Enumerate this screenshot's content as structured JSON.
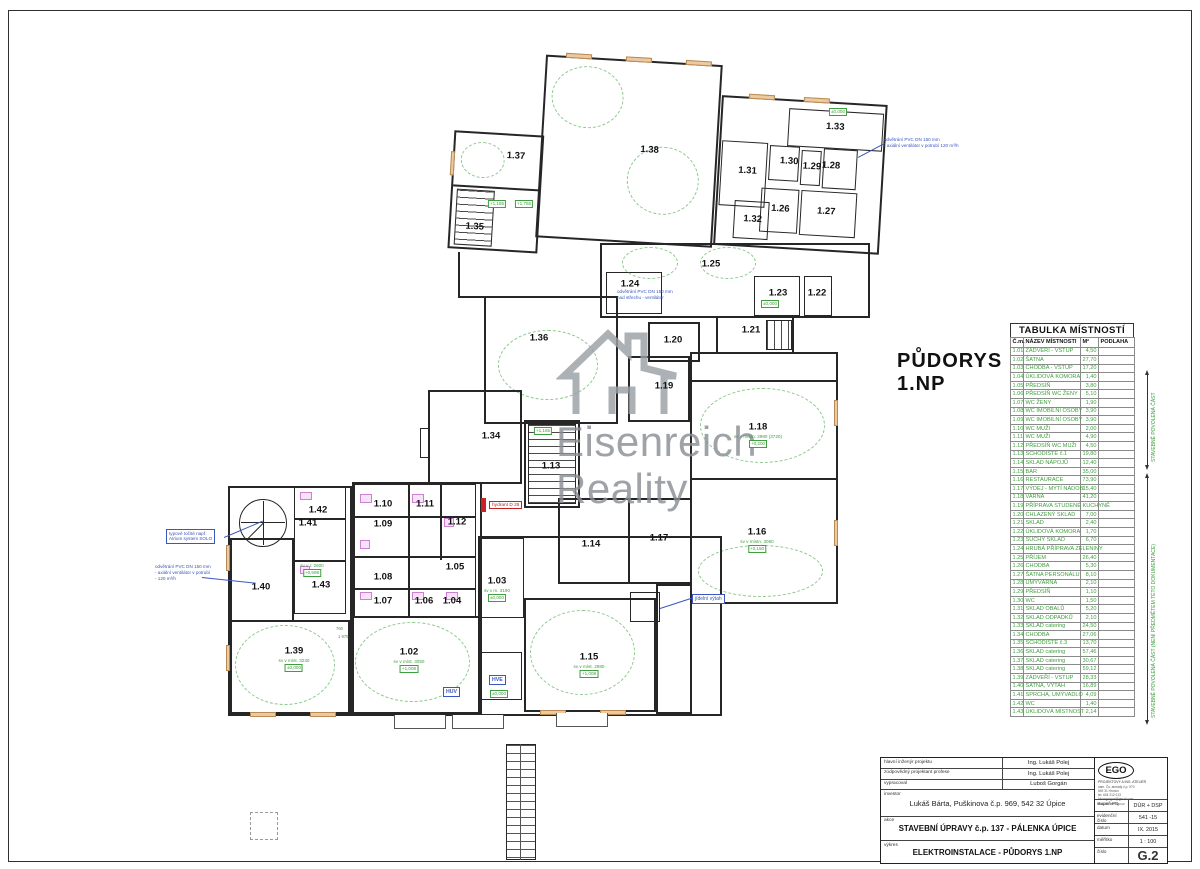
{
  "colors": {
    "green": "#3f9e3f",
    "blue": "#3a56c0",
    "red": "#cc2222",
    "wall": "#262626",
    "tan": "#ecc9a0",
    "pink": "#cf7fd4",
    "watermark_gray": "#8b9095"
  },
  "plan_title": {
    "line1": "PŮDORYS",
    "line2": "1.NP"
  },
  "watermark": {
    "line1": "Eisenreich",
    "line2": "Reality"
  },
  "room_table": {
    "title": "TABULKA MÍSTNOSTÍ",
    "columns": [
      "Č.m.",
      "NÁZEV MÍSTNOSTI",
      "M²",
      "PODLAHA"
    ],
    "rows": [
      [
        "1.01",
        "ZÁDVEŘÍ - VSTUP",
        "4,50"
      ],
      [
        "1.02",
        "ŠATNA",
        "27,70"
      ],
      [
        "1.03",
        "CHODBA - VSTUP",
        "17,20"
      ],
      [
        "1.04",
        "ÚKLIDOVÁ KOMORA",
        "1,40"
      ],
      [
        "1.05",
        "PŘEDSÍŇ",
        "3,80"
      ],
      [
        "1.06",
        "PŘEDSÍŇ WC ŽENY",
        "5,10"
      ],
      [
        "1.07",
        "WC ŽENY",
        "1,90"
      ],
      [
        "1.08",
        "WC IMOBILNÍ OSOBY",
        "3,90"
      ],
      [
        "1.09",
        "WC IMOBILNÍ OSOBY",
        "3,90"
      ],
      [
        "1.10",
        "WC MUŽI",
        "2,00"
      ],
      [
        "1.11",
        "WC MUŽI",
        "4,90"
      ],
      [
        "1.12",
        "PŘEDSÍŇ WC MUŽI",
        "4,50"
      ],
      [
        "1.13",
        "SCHODIŠTĚ č.1",
        "19,80"
      ],
      [
        "1.14",
        "SKLAD NÁPOJŮ",
        "12,40"
      ],
      [
        "1.15",
        "BAR",
        "35,00"
      ],
      [
        "1.16",
        "RESTAURACE",
        "73,90"
      ],
      [
        "1.17",
        "VÝDEJ - MYTÍ NÁDOBÍ",
        "15,40"
      ],
      [
        "1.18",
        "VARNA",
        "41,20"
      ],
      [
        "1.19",
        "PŘÍPRAVA STUDENÉ KUCHYNĚ",
        ""
      ],
      [
        "1.20",
        "CHLAZENÝ SKLAD",
        "7,00"
      ],
      [
        "1.21",
        "SKLAD",
        "2,40"
      ],
      [
        "1.22",
        "ÚKLIDOVÁ KOMORA",
        "1,70"
      ],
      [
        "1.23",
        "SUCHÝ SKLAD",
        "6,70"
      ],
      [
        "1.24",
        "HRUBÁ PŘÍPRAVA ZELENINY",
        ""
      ],
      [
        "1.25",
        "PŘÍJEM",
        "26,40"
      ],
      [
        "1.26",
        "CHODBA",
        "5,30"
      ],
      [
        "1.27",
        "ŠATNA PERSONÁLU",
        "8,10"
      ],
      [
        "1.28",
        "UMÝVÁRNA",
        "2,10"
      ],
      [
        "1.29",
        "PŘEDSÍŇ",
        "1,10"
      ],
      [
        "1.30",
        "WC",
        "1,50"
      ],
      [
        "1.31",
        "SKLAD OBALŮ",
        "5,20"
      ],
      [
        "1.32",
        "SKLAD ODPADKŮ",
        "2,10"
      ],
      [
        "1.33",
        "SKLAD catering",
        "24,50"
      ],
      [
        "1.34",
        "CHODBA",
        "27,06"
      ],
      [
        "1.35",
        "SCHODIŠTĚ č.3",
        "13,70"
      ],
      [
        "1.36",
        "SKLAD catering",
        "57,46"
      ],
      [
        "1.37",
        "SKLAD catering",
        "30,67"
      ],
      [
        "1.38",
        "SKLAD catering",
        "59,12"
      ],
      [
        "1.39",
        "ZÁDVEŘÍ - VSTUP",
        "28,33"
      ],
      [
        "1.40",
        "ŠATNA, VÝTAH",
        "16,89"
      ],
      [
        "1.41",
        "SPRCHA, UMÝVADLO",
        "4,09"
      ],
      [
        "1.42",
        "WC",
        "1,40"
      ],
      [
        "1.43",
        "ÚKLIDOVÁ MÍSTNOST",
        "2,14"
      ]
    ]
  },
  "side_notes": {
    "upper": "STAVEBNĚ POVOLENÁ ČÁST",
    "lower": "STAVEBNĚ POVOLENÁ ČÁST (NENÍ PŘEDMĚTEM TÉTO DOKUMENTACE)"
  },
  "annotations": {
    "spiral_stair": {
      "lines": [
        "typové točité např.",
        "Atrium system SOLO"
      ]
    },
    "vent_left": {
      "lines": [
        "odvětrání PVC DN 150 mm",
        "- axiální ventilátor v potrubí",
        "- 120 m³/h"
      ]
    },
    "vent_top_right": {
      "lines": [
        "odvětrání PVC DN 150 mm",
        "- axiální ventilátor v potrubí 120 m³/h"
      ]
    },
    "vent_roof": {
      "lines": [
        "odvětrání PVC DN 150 mm",
        "nad střechu - ventilátor"
      ]
    },
    "dumbwaiter": "jídelní výtah",
    "hydrant": "hydrant D 25",
    "hve": "HVE",
    "huv": "HUV"
  },
  "plan": {
    "labels": [
      {
        "t": "1.25",
        "x": 711,
        "y": 264
      },
      {
        "t": "1.24",
        "x": 630,
        "y": 284
      },
      {
        "t": "1.23",
        "x": 778,
        "y": 293
      },
      {
        "t": "1.22",
        "x": 817,
        "y": 293
      },
      {
        "t": "1.21",
        "x": 751,
        "y": 330
      },
      {
        "t": "1.20",
        "x": 673,
        "y": 340
      },
      {
        "t": "1.36",
        "x": 539,
        "y": 338
      },
      {
        "t": "1.19",
        "x": 664,
        "y": 386
      },
      {
        "t": "1.18",
        "x": 758,
        "y": 427
      },
      {
        "t": "1.34",
        "x": 491,
        "y": 436
      },
      {
        "t": "1.13",
        "x": 551,
        "y": 466
      },
      {
        "t": "1.10",
        "x": 383,
        "y": 504
      },
      {
        "t": "1.11",
        "x": 425,
        "y": 504
      },
      {
        "t": "1.42",
        "x": 318,
        "y": 510
      },
      {
        "t": "1.09",
        "x": 383,
        "y": 524
      },
      {
        "t": "1.12",
        "x": 457,
        "y": 522
      },
      {
        "t": "1.41",
        "x": 308,
        "y": 523
      },
      {
        "t": "1.16",
        "x": 757,
        "y": 532
      },
      {
        "t": "1.14",
        "x": 591,
        "y": 544
      },
      {
        "t": "1.17",
        "x": 659,
        "y": 538
      },
      {
        "t": "1.05",
        "x": 455,
        "y": 567
      },
      {
        "t": "1.08",
        "x": 383,
        "y": 577
      },
      {
        "t": "1.43",
        "x": 321,
        "y": 585
      },
      {
        "t": "1.40",
        "x": 261,
        "y": 587
      },
      {
        "t": "1.03",
        "x": 497,
        "y": 581
      },
      {
        "t": "1.07",
        "x": 383,
        "y": 601
      },
      {
        "t": "1.06",
        "x": 424,
        "y": 601
      },
      {
        "t": "1.04",
        "x": 452,
        "y": 601
      },
      {
        "t": "1.39",
        "x": 294,
        "y": 651
      },
      {
        "t": "1.02",
        "x": 409,
        "y": 652
      },
      {
        "t": "1.15",
        "x": 589,
        "y": 657
      }
    ],
    "top_wing_labels": [
      {
        "t": "1.37",
        "x": 71,
        "y": 116
      },
      {
        "t": "1.35",
        "x": 34,
        "y": 189
      },
      {
        "t": "1.38",
        "x": 204,
        "y": 102
      },
      {
        "t": "1.33",
        "x": 388,
        "y": 68
      },
      {
        "t": "1.31",
        "x": 303,
        "y": 117
      },
      {
        "t": "1.30",
        "x": 344,
        "y": 105
      },
      {
        "t": "1.29",
        "x": 367,
        "y": 109
      },
      {
        "t": "1.28",
        "x": 386,
        "y": 107
      },
      {
        "t": "1.26",
        "x": 338,
        "y": 153
      },
      {
        "t": "1.27",
        "x": 384,
        "y": 153
      },
      {
        "t": "1.32",
        "x": 311,
        "y": 165
      }
    ],
    "green_marks": [
      {
        "x": 543,
        "y": 427,
        "lines": [
          "+1,165"
        ]
      },
      {
        "x": 497,
        "y": 200,
        "lines": [
          "+1,165"
        ]
      },
      {
        "x": 524,
        "y": 200,
        "lines": [
          "+1,755"
        ]
      },
      {
        "x": 294,
        "y": 658,
        "lines": [
          "sv v míst. 3240",
          "±0,000"
        ]
      },
      {
        "x": 409,
        "y": 659,
        "lines": [
          "sv v míst. 3050",
          "+1,008"
        ]
      },
      {
        "x": 589,
        "y": 664,
        "lines": [
          "sv v míst. 2980",
          "+1,008"
        ]
      },
      {
        "x": 758,
        "y": 434,
        "lines": [
          "sv v místn. 2980 (3720)",
          "+0,200"
        ]
      },
      {
        "x": 757,
        "y": 539,
        "lines": [
          "sv v místn. 3060",
          "+0,150"
        ]
      },
      {
        "x": 312,
        "y": 563,
        "lines": [
          "sv v r. 2600",
          "+0,598"
        ]
      },
      {
        "x": 497,
        "y": 588,
        "lines": [
          "sv v m. 3190",
          "±0,000"
        ]
      },
      {
        "x": 499,
        "y": 690,
        "lines": [
          "±0,000"
        ]
      },
      {
        "x": 770,
        "y": 300,
        "lines": [
          "±0,000"
        ]
      },
      {
        "x": 838,
        "y": 108,
        "lines": [
          "±0,000"
        ]
      }
    ],
    "dims": [
      {
        "t": "760",
        "x": 336,
        "y": 626
      },
      {
        "t": "1 975",
        "x": 338,
        "y": 634
      }
    ]
  },
  "title_block": {
    "rows": [
      {
        "label": "hlavní inženýr projektu",
        "value": "Ing. Lukáš Polej"
      },
      {
        "label": "zodpovědný projektant profese",
        "value": "Ing. Lukáš Polej"
      },
      {
        "label": "vypracoval",
        "value": "Luboš Gorgán"
      }
    ],
    "investor": {
      "label": "investor",
      "value": "Lukáš Bárta, Puškinova č.p. 969, 542 32 Úpice"
    },
    "akce": {
      "label": "akce",
      "value": "STAVEBNÍ ÚPRAVY č.p. 137 - PÁLENKA ÚPICE"
    },
    "vykres": {
      "label": "výkres",
      "value": "ELEKTROINSTALACE - PŮDORYS  1.NP"
    },
    "company": {
      "name": "EGO",
      "subtitle": "PROJEKTOVÝ A ING. ATELIÉR",
      "address": [
        "nám. Čs. armády č.p. 970",
        "549 31 Hronov",
        "tel. 604 212 013",
        "lubosgorgan@gmail.com",
        "www.atelier-ego.cz"
      ]
    },
    "meta": [
      {
        "label": "stupeň PD",
        "value": "DÚR + DSP"
      },
      {
        "label": "evidenční číslo",
        "value": "541 -15"
      },
      {
        "label": "datum",
        "value": "IX. 2015"
      },
      {
        "label": "měřítko",
        "value": "1 : 100"
      }
    ],
    "number": {
      "label": "číslo",
      "value": "G.2"
    }
  }
}
